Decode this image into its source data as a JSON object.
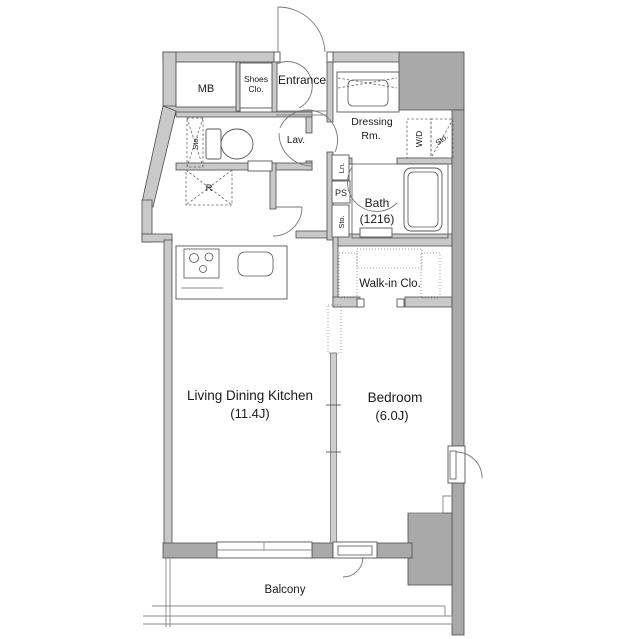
{
  "plan": {
    "type": "apartment-floor-plan",
    "rooms": {
      "mb": {
        "label": "MB"
      },
      "shoes_closet": {
        "line1": "Shoes",
        "line2": "Clo."
      },
      "entrance": {
        "label": "Entrance"
      },
      "lavatory": {
        "label": "Lav."
      },
      "storage_lavatory": {
        "label": "Sto."
      },
      "refrigerator_space": {
        "label": "R"
      },
      "dressing_room": {
        "line1": "Dressing",
        "line2": "Rm."
      },
      "washer_dryer": {
        "label": "W/D"
      },
      "storage_dressing": {
        "label": "Sto."
      },
      "linen": {
        "label": "Ln."
      },
      "pipe_space": {
        "label": "PS"
      },
      "storage_hall": {
        "label": "Sto."
      },
      "bath": {
        "line1": "Bath",
        "line2": "(1216)"
      },
      "walk_in_closet": {
        "label": "Walk-in Clo."
      },
      "living_dining_kitchen": {
        "line1": "Living Dining Kitchen",
        "line2": "(11.4J)"
      },
      "bedroom": {
        "line1": "Bedroom",
        "line2": "(6.0J)"
      },
      "balcony": {
        "label": "Balcony"
      }
    },
    "colors": {
      "background": "#ffffff",
      "wall_light": "#c9c9c9",
      "wall_dark": "#a9a9a9",
      "outline": "#4d4d4d",
      "fixture_line": "#555555",
      "text": "#1a1a1a"
    }
  }
}
